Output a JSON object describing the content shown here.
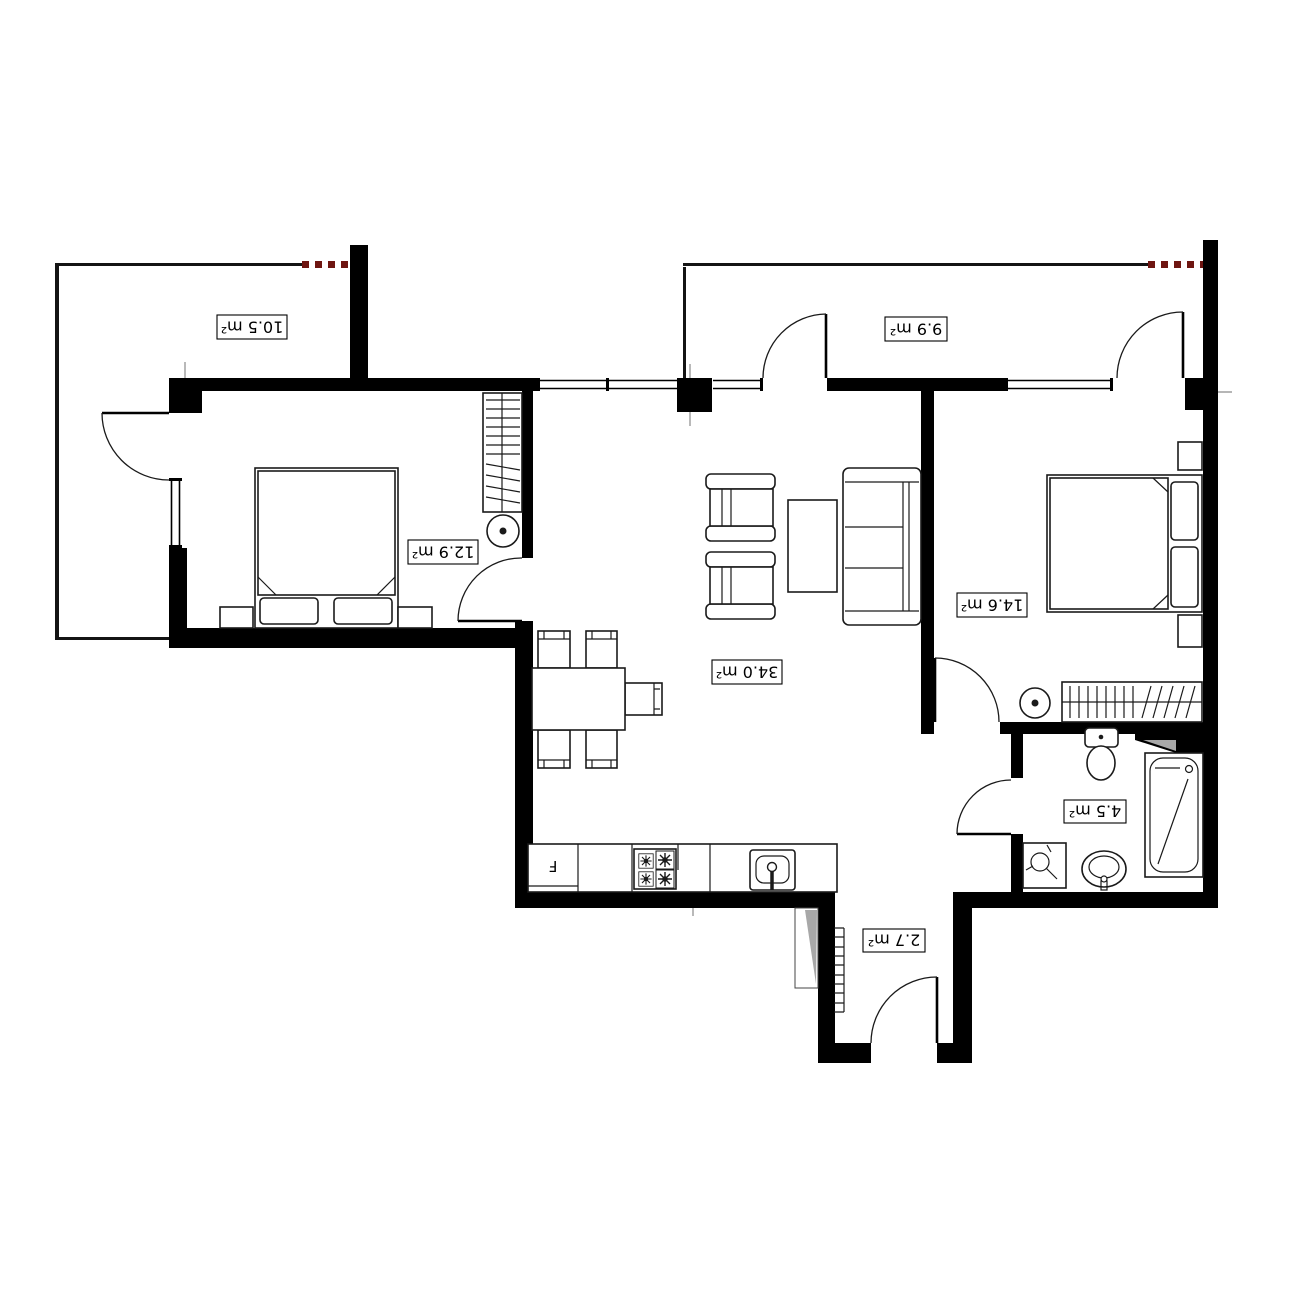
{
  "floor_plan": {
    "rooms": [
      {
        "id": "balcony_left",
        "area_label": "10.5 m²"
      },
      {
        "id": "balcony_right",
        "area_label": "9.9 m²"
      },
      {
        "id": "bedroom_left",
        "area_label": "12.9 m²"
      },
      {
        "id": "bedroom_right",
        "area_label": "14.6 m²"
      },
      {
        "id": "living_kitchen",
        "area_label": "34.0 m²"
      },
      {
        "id": "bathroom",
        "area_label": "4.5 m²"
      },
      {
        "id": "entrance_hall",
        "area_label": "2.7 m²"
      }
    ],
    "appliances": {
      "fridge_label": "F"
    },
    "colors": {
      "walls": "#000000",
      "demolition_red": "#6e1511",
      "shade": "#a8a8a8"
    }
  }
}
